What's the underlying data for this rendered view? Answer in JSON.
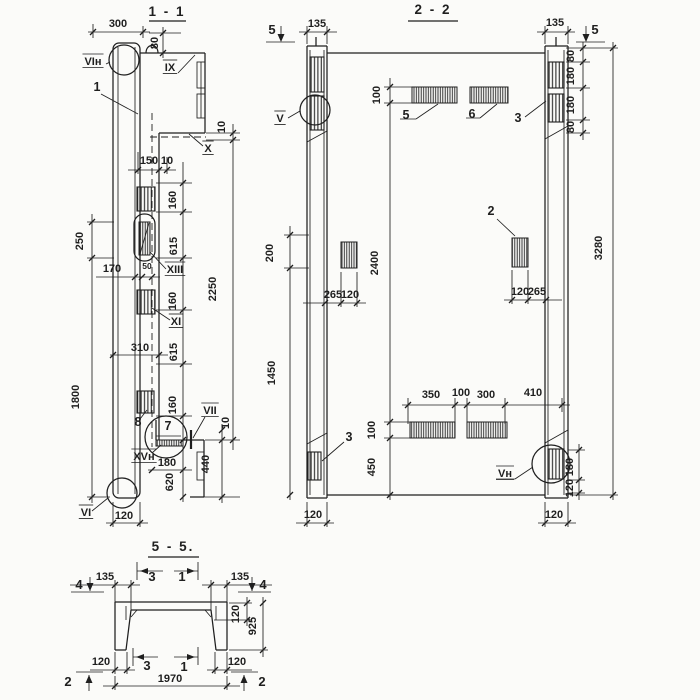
{
  "page": {
    "background": "#fbfbf9",
    "ink": "#1f1f1f"
  },
  "drawing": {
    "sections": [
      {
        "id": "s11",
        "title": "1 - 1",
        "labels": [
          {
            "t": "300",
            "x": 118,
            "y": 27
          },
          {
            "t": "80",
            "x": 158,
            "y": 43,
            "r": 1
          },
          {
            "t": "VIн",
            "x": 93,
            "y": 65,
            "cls": "ref"
          },
          {
            "t": "1",
            "x": 97,
            "y": 91,
            "cls": "item"
          },
          {
            "t": "IX",
            "x": 170,
            "y": 71,
            "cls": "ref"
          },
          {
            "t": "150",
            "x": 149,
            "y": 164
          },
          {
            "t": "10",
            "x": 167,
            "y": 164
          },
          {
            "t": "X",
            "x": 208,
            "y": 152,
            "cls": "ref"
          },
          {
            "t": "10",
            "x": 225,
            "y": 127,
            "r": 1
          },
          {
            "t": "160",
            "x": 176,
            "y": 200,
            "r": 1
          },
          {
            "t": "615",
            "x": 177,
            "y": 246,
            "r": 1
          },
          {
            "t": "2250",
            "x": 216,
            "y": 289,
            "r": 1
          },
          {
            "t": "250",
            "x": 83,
            "y": 241,
            "r": 1
          },
          {
            "t": "170",
            "x": 112,
            "y": 272
          },
          {
            "t": "50",
            "x": 147,
            "y": 269,
            "cls": "dims"
          },
          {
            "t": "XIII",
            "x": 175,
            "y": 273,
            "cls": "ref"
          },
          {
            "t": "160",
            "x": 176,
            "y": 301,
            "r": 1
          },
          {
            "t": "XI",
            "x": 176,
            "y": 325,
            "cls": "ref"
          },
          {
            "t": "310",
            "x": 140,
            "y": 351
          },
          {
            "t": "615",
            "x": 177,
            "y": 352,
            "r": 1
          },
          {
            "t": "1800",
            "x": 79,
            "y": 397,
            "r": 1
          },
          {
            "t": "160",
            "x": 176,
            "y": 405,
            "r": 1
          },
          {
            "t": "VII",
            "x": 210,
            "y": 414,
            "cls": "ref"
          },
          {
            "t": "10",
            "x": 229,
            "y": 423,
            "r": 1
          },
          {
            "t": "8",
            "x": 138,
            "y": 426,
            "cls": "item"
          },
          {
            "t": "7",
            "x": 168,
            "y": 430,
            "cls": "item"
          },
          {
            "t": "XVн",
            "x": 144,
            "y": 460,
            "cls": "ref"
          },
          {
            "t": "180",
            "x": 167,
            "y": 466
          },
          {
            "t": "620",
            "x": 173,
            "y": 482,
            "r": 1
          },
          {
            "t": "440",
            "x": 209,
            "y": 464,
            "r": 1
          },
          {
            "t": "VI",
            "x": 86,
            "y": 516,
            "cls": "ref"
          },
          {
            "t": "120",
            "x": 124,
            "y": 519
          }
        ]
      },
      {
        "id": "s22",
        "title": "2 - 2",
        "labels": [
          {
            "t": "5",
            "x": 272,
            "y": 34,
            "cls": "marker"
          },
          {
            "t": "135",
            "x": 317,
            "y": 27
          },
          {
            "t": "135",
            "x": 555,
            "y": 26
          },
          {
            "t": "5",
            "x": 595,
            "y": 34,
            "cls": "marker"
          },
          {
            "t": "V",
            "x": 280,
            "y": 122,
            "cls": "ref"
          },
          {
            "t": "100",
            "x": 380,
            "y": 95,
            "r": 1
          },
          {
            "t": "5",
            "x": 406,
            "y": 119,
            "cls": "item"
          },
          {
            "t": "6",
            "x": 472,
            "y": 118,
            "cls": "item"
          },
          {
            "t": "3",
            "x": 518,
            "y": 122,
            "cls": "item"
          },
          {
            "t": "80",
            "x": 574,
            "y": 56,
            "r": 1
          },
          {
            "t": "180",
            "x": 574,
            "y": 76,
            "r": 1
          },
          {
            "t": "180",
            "x": 574,
            "y": 105,
            "r": 1
          },
          {
            "t": "80",
            "x": 574,
            "y": 127,
            "r": 1
          },
          {
            "t": "2",
            "x": 491,
            "y": 215,
            "cls": "item"
          },
          {
            "t": "3280",
            "x": 602,
            "y": 248,
            "r": 1
          },
          {
            "t": "2400",
            "x": 378,
            "y": 263,
            "r": 1
          },
          {
            "t": "200",
            "x": 273,
            "y": 253,
            "r": 1
          },
          {
            "t": "265",
            "x": 333,
            "y": 298
          },
          {
            "t": "120",
            "x": 350,
            "y": 298
          },
          {
            "t": "120",
            "x": 520,
            "y": 295
          },
          {
            "t": "265",
            "x": 537,
            "y": 295
          },
          {
            "t": "1450",
            "x": 275,
            "y": 373,
            "r": 1
          },
          {
            "t": "350",
            "x": 431,
            "y": 398
          },
          {
            "t": "100",
            "x": 461,
            "y": 396
          },
          {
            "t": "300",
            "x": 486,
            "y": 398
          },
          {
            "t": "410",
            "x": 533,
            "y": 396
          },
          {
            "t": "100",
            "x": 375,
            "y": 430,
            "r": 1
          },
          {
            "t": "450",
            "x": 375,
            "y": 467,
            "r": 1
          },
          {
            "t": "3",
            "x": 349,
            "y": 441,
            "cls": "item"
          },
          {
            "t": "Vн",
            "x": 505,
            "y": 477,
            "cls": "ref"
          },
          {
            "t": "180",
            "x": 573,
            "y": 467,
            "r": 1
          },
          {
            "t": "120",
            "x": 573,
            "y": 488,
            "r": 1
          },
          {
            "t": "120",
            "x": 313,
            "y": 518
          },
          {
            "t": "120",
            "x": 554,
            "y": 518
          }
        ]
      },
      {
        "id": "s55",
        "title": "5 - 5.",
        "labels": [
          {
            "t": "4",
            "x": 79,
            "y": 589,
            "cls": "marker"
          },
          {
            "t": "135",
            "x": 105,
            "y": 580
          },
          {
            "t": "3",
            "x": 152,
            "y": 581,
            "cls": "marker"
          },
          {
            "t": "1",
            "x": 182,
            "y": 581,
            "cls": "marker"
          },
          {
            "t": "135",
            "x": 240,
            "y": 580
          },
          {
            "t": "4",
            "x": 263,
            "y": 589,
            "cls": "marker"
          },
          {
            "t": "120",
            "x": 239,
            "y": 614,
            "r": 1
          },
          {
            "t": "925",
            "x": 256,
            "y": 626,
            "r": 1
          },
          {
            "t": "120",
            "x": 101,
            "y": 665
          },
          {
            "t": "120",
            "x": 237,
            "y": 665
          },
          {
            "t": "3",
            "x": 147,
            "y": 670,
            "cls": "marker"
          },
          {
            "t": "1",
            "x": 184,
            "y": 671,
            "cls": "marker"
          },
          {
            "t": "1970",
            "x": 170,
            "y": 682
          },
          {
            "t": "2",
            "x": 68,
            "y": 686,
            "cls": "marker"
          },
          {
            "t": "2",
            "x": 262,
            "y": 686,
            "cls": "marker"
          }
        ]
      }
    ]
  }
}
